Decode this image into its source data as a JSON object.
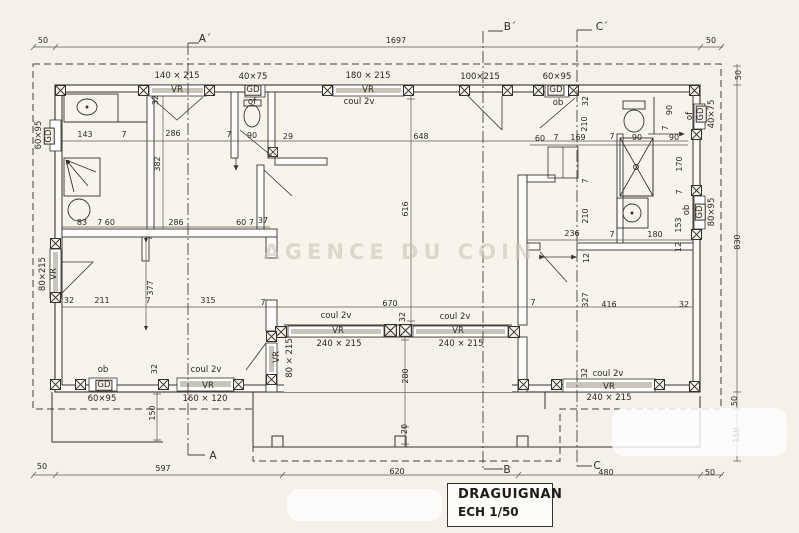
{
  "watermark": "AGENCE DU COIN",
  "title_block": {
    "location": "DRAGUIGNAN",
    "scale": "ECH 1/50"
  },
  "colors": {
    "paper": "#f4f1e9",
    "ink": "#35332e",
    "shutter_gray": "#c9c5ba",
    "watermark_gray": "#ccc7b8"
  },
  "labels": [
    {
      "t": "50",
      "x": 43,
      "y": 41
    },
    {
      "t": "1697",
      "x": 396,
      "y": 41
    },
    {
      "t": "50",
      "x": 711,
      "y": 41
    },
    {
      "t": "A´",
      "x": 205,
      "y": 39,
      "k": "m"
    },
    {
      "t": "B´",
      "x": 510,
      "y": 27,
      "k": "m"
    },
    {
      "t": "C´",
      "x": 602,
      "y": 27,
      "k": "m"
    },
    {
      "t": "A",
      "x": 213,
      "y": 456,
      "k": "m"
    },
    {
      "t": "B",
      "x": 507,
      "y": 470,
      "k": "m"
    },
    {
      "t": "C",
      "x": 597,
      "y": 466,
      "k": "m"
    },
    {
      "t": "50",
      "x": 42,
      "y": 467
    },
    {
      "t": "597",
      "x": 163,
      "y": 469
    },
    {
      "t": "620",
      "x": 397,
      "y": 472
    },
    {
      "t": "480",
      "x": 606,
      "y": 473
    },
    {
      "t": "50",
      "x": 710,
      "y": 473
    },
    {
      "t": "50",
      "x": 739,
      "y": 75,
      "r": 1
    },
    {
      "t": "830",
      "x": 738,
      "y": 242,
      "r": 1
    },
    {
      "t": "50",
      "x": 735,
      "y": 401,
      "r": 1
    },
    {
      "t": "150",
      "x": 737,
      "y": 435,
      "r": 1
    },
    {
      "t": "150",
      "x": 153,
      "y": 413,
      "r": 1
    },
    {
      "t": "143",
      "x": 85,
      "y": 135
    },
    {
      "t": "7",
      "x": 124,
      "y": 135
    },
    {
      "t": "286",
      "x": 173,
      "y": 134
    },
    {
      "t": "7",
      "x": 229,
      "y": 135
    },
    {
      "t": "90",
      "x": 252,
      "y": 136
    },
    {
      "t": "29",
      "x": 288,
      "y": 137
    },
    {
      "t": "648",
      "x": 421,
      "y": 137
    },
    {
      "t": "32",
      "x": 156,
      "y": 100,
      "r": 1
    },
    {
      "t": "382",
      "x": 158,
      "y": 164,
      "r": 1
    },
    {
      "t": "7",
      "x": 150,
      "y": 238,
      "r": 1
    },
    {
      "t": "377",
      "x": 151,
      "y": 288,
      "r": 1
    },
    {
      "t": "83",
      "x": 82,
      "y": 223
    },
    {
      "t": "7 60",
      "x": 106,
      "y": 223
    },
    {
      "t": "286",
      "x": 176,
      "y": 223
    },
    {
      "t": "60 7",
      "x": 245,
      "y": 223
    },
    {
      "t": "37",
      "x": 263,
      "y": 221
    },
    {
      "t": "32",
      "x": 69,
      "y": 301
    },
    {
      "t": "211",
      "x": 102,
      "y": 301
    },
    {
      "t": "7",
      "x": 148,
      "y": 301
    },
    {
      "t": "315",
      "x": 208,
      "y": 301
    },
    {
      "t": "616",
      "x": 406,
      "y": 209,
      "r": 1
    },
    {
      "t": "670",
      "x": 390,
      "y": 304
    },
    {
      "t": "7",
      "x": 263,
      "y": 303
    },
    {
      "t": "7",
      "x": 533,
      "y": 303
    },
    {
      "t": "32",
      "x": 403,
      "y": 317,
      "r": 1
    },
    {
      "t": "280",
      "x": 406,
      "y": 376,
      "r": 1
    },
    {
      "t": "20",
      "x": 405,
      "y": 429,
      "r": 1
    },
    {
      "t": "60",
      "x": 540,
      "y": 139
    },
    {
      "t": "7",
      "x": 556,
      "y": 138
    },
    {
      "t": "169",
      "x": 578,
      "y": 138
    },
    {
      "t": "7",
      "x": 612,
      "y": 137
    },
    {
      "t": "90",
      "x": 637,
      "y": 138
    },
    {
      "t": "90",
      "x": 674,
      "y": 138
    },
    {
      "t": "32",
      "x": 586,
      "y": 101,
      "r": 1
    },
    {
      "t": "210",
      "x": 585,
      "y": 124,
      "r": 1
    },
    {
      "t": "7",
      "x": 586,
      "y": 181,
      "r": 1
    },
    {
      "t": "210",
      "x": 586,
      "y": 216,
      "r": 1
    },
    {
      "t": "12",
      "x": 587,
      "y": 258,
      "r": 1
    },
    {
      "t": "327",
      "x": 586,
      "y": 300,
      "r": 1
    },
    {
      "t": "90",
      "x": 670,
      "y": 110,
      "r": 1
    },
    {
      "t": "7",
      "x": 666,
      "y": 128,
      "r": 1
    },
    {
      "t": "170",
      "x": 680,
      "y": 164,
      "r": 1
    },
    {
      "t": "7",
      "x": 680,
      "y": 192,
      "r": 1
    },
    {
      "t": "153",
      "x": 679,
      "y": 225,
      "r": 1
    },
    {
      "t": "12",
      "x": 679,
      "y": 247,
      "r": 1
    },
    {
      "t": "ob",
      "x": 687,
      "y": 210,
      "r": 1,
      "k": "c"
    },
    {
      "t": "236",
      "x": 572,
      "y": 234
    },
    {
      "t": "7",
      "x": 612,
      "y": 235
    },
    {
      "t": "180",
      "x": 655,
      "y": 235
    },
    {
      "t": "416",
      "x": 609,
      "y": 305
    },
    {
      "t": "32",
      "x": 684,
      "y": 305
    },
    {
      "t": "140 × 215",
      "x": 177,
      "y": 76,
      "k": "s"
    },
    {
      "t": "VR",
      "x": 177,
      "y": 90,
      "k": "c"
    },
    {
      "t": "40×75",
      "x": 253,
      "y": 77,
      "k": "s"
    },
    {
      "t": "GD",
      "x": 253,
      "y": 90,
      "k": "c",
      "b": 1
    },
    {
      "t": "of",
      "x": 252,
      "y": 102,
      "k": "c"
    },
    {
      "t": "180 × 215",
      "x": 368,
      "y": 76,
      "k": "s"
    },
    {
      "t": "VR",
      "x": 368,
      "y": 90,
      "k": "c"
    },
    {
      "t": "coul 2v",
      "x": 359,
      "y": 102,
      "k": "c"
    },
    {
      "t": "100×215",
      "x": 480,
      "y": 77,
      "k": "s"
    },
    {
      "t": "60×95",
      "x": 557,
      "y": 77,
      "k": "s"
    },
    {
      "t": "GD",
      "x": 556,
      "y": 90,
      "k": "c",
      "b": 1
    },
    {
      "t": "ob",
      "x": 558,
      "y": 103,
      "k": "c"
    },
    {
      "t": "40×75",
      "x": 712,
      "y": 114,
      "r": 1,
      "k": "s"
    },
    {
      "t": "GD",
      "x": 701,
      "y": 114,
      "r": 1,
      "k": "c",
      "b": 1
    },
    {
      "t": "of",
      "x": 690,
      "y": 116,
      "r": 1,
      "k": "c"
    },
    {
      "t": "80×95",
      "x": 712,
      "y": 212,
      "r": 1,
      "k": "s"
    },
    {
      "t": "GD",
      "x": 700,
      "y": 212,
      "r": 1,
      "k": "c",
      "b": 1
    },
    {
      "t": "60×95",
      "x": 39,
      "y": 135,
      "r": 1,
      "k": "s"
    },
    {
      "t": "GD",
      "x": 49,
      "y": 136,
      "r": 1,
      "k": "c",
      "b": 1
    },
    {
      "t": "80×215",
      "x": 43,
      "y": 274,
      "r": 1,
      "k": "s"
    },
    {
      "t": "VR",
      "x": 54,
      "y": 274,
      "r": 1,
      "k": "c"
    },
    {
      "t": "ob",
      "x": 103,
      "y": 370,
      "k": "c"
    },
    {
      "t": "GD",
      "x": 104,
      "y": 385,
      "k": "c",
      "b": 1
    },
    {
      "t": "60×95",
      "x": 102,
      "y": 399,
      "k": "s"
    },
    {
      "t": "32",
      "x": 155,
      "y": 369,
      "r": 1
    },
    {
      "t": "coul 2v",
      "x": 206,
      "y": 370,
      "k": "c"
    },
    {
      "t": "VR",
      "x": 208,
      "y": 386,
      "k": "c"
    },
    {
      "t": "160 × 120",
      "x": 205,
      "y": 399,
      "k": "s"
    },
    {
      "t": "VR",
      "x": 277,
      "y": 357,
      "r": 1,
      "k": "c"
    },
    {
      "t": "80 × 215",
      "x": 290,
      "y": 358,
      "r": 1,
      "k": "s"
    },
    {
      "t": "coul 2v",
      "x": 336,
      "y": 316,
      "k": "c"
    },
    {
      "t": "VR",
      "x": 338,
      "y": 331,
      "k": "c"
    },
    {
      "t": "240 × 215",
      "x": 339,
      "y": 344,
      "k": "s"
    },
    {
      "t": "coul 2v",
      "x": 455,
      "y": 317,
      "k": "c"
    },
    {
      "t": "VR",
      "x": 458,
      "y": 331,
      "k": "c"
    },
    {
      "t": "240 × 215",
      "x": 461,
      "y": 344,
      "k": "s"
    },
    {
      "t": "32",
      "x": 585,
      "y": 373,
      "r": 1
    },
    {
      "t": "coul 2v",
      "x": 608,
      "y": 374,
      "k": "c"
    },
    {
      "t": "VR",
      "x": 609,
      "y": 387,
      "k": "c"
    },
    {
      "t": "240 × 215",
      "x": 609,
      "y": 398,
      "k": "s"
    }
  ]
}
